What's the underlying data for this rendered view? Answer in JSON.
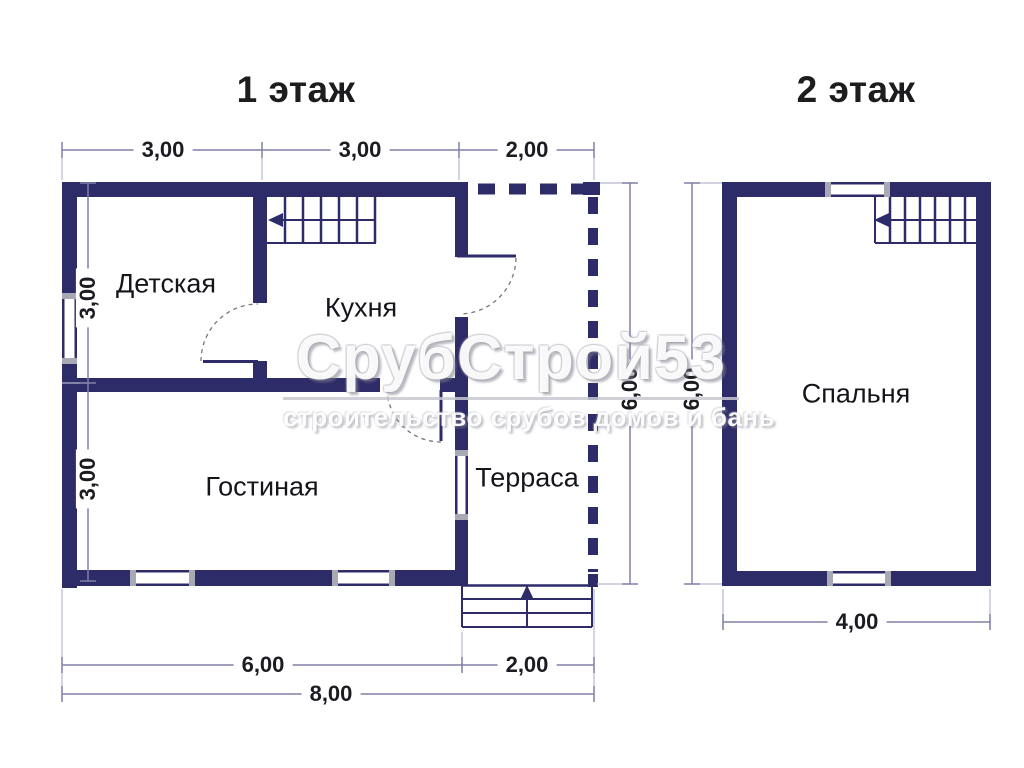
{
  "page": {
    "background": "#ffffff"
  },
  "colors": {
    "wall": "#2e2c68",
    "dim_line": "#8080a8",
    "extension_line": "#b6b6cf",
    "door_arc": "#777777",
    "window_cap": "#a9a9b6",
    "text": "#15151c"
  },
  "floor1": {
    "title": "1 этаж",
    "rooms": {
      "nursery": "Детская",
      "kitchen": "Кухня",
      "living": "Гостиная",
      "terrace": "Терраса"
    },
    "dims": {
      "top": [
        "3,00",
        "3,00",
        "2,00"
      ],
      "left": [
        "3,00",
        "3,00"
      ],
      "right": "6,00",
      "bottom_inner": [
        "6,00",
        "2,00"
      ],
      "bottom_total": "8,00"
    }
  },
  "floor2": {
    "title": "2 этаж",
    "rooms": {
      "bedroom": "Спальня"
    },
    "dims": {
      "left": "6,00",
      "bottom": "4,00"
    }
  },
  "watermark": {
    "brand": "СрубСтрой53",
    "tagline": "строительство срубов домов и бань"
  }
}
